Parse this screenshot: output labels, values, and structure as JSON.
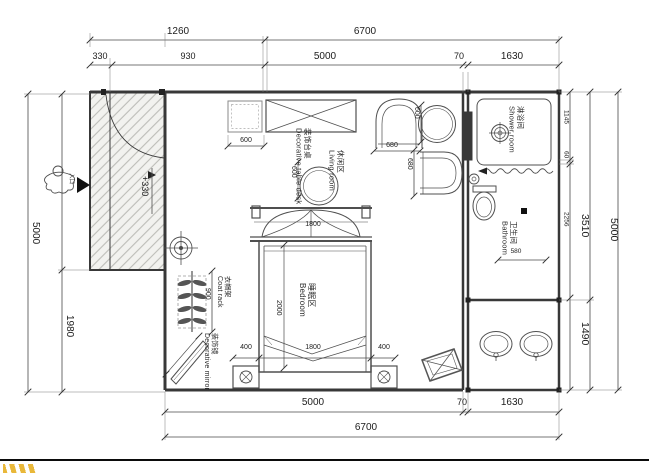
{
  "plan": {
    "dims": {
      "t1260": "1260",
      "t6700": "6700",
      "t330": "330",
      "t930": "930",
      "t5000": "5000",
      "t70": "70",
      "t1630": "1630",
      "b5000": "5000",
      "b70": "70",
      "b1630": "1630",
      "b6700": "6700",
      "l5000": "5000",
      "l1980": "1980",
      "r1145": "1145",
      "r60": "60",
      "r2256": "2256",
      "r3510": "3510",
      "r1490": "1490",
      "r5000": "5000",
      "cab600": "600",
      "tbl600": "600",
      "seat600": "600",
      "chair680w": "680",
      "chair680d": "680",
      "canopy1800": "1800",
      "bed2000": "2000",
      "bed1800": "1800",
      "nl400": "400",
      "nr400": "400",
      "coat900": "900",
      "bath580": "580",
      "level": "+330"
    },
    "labels": {
      "entrance": "入口",
      "decor_table": {
        "zh": "装饰台桌",
        "en": "Decorative table desk"
      },
      "living": {
        "zh": "休闲区",
        "en": "Living room"
      },
      "bedroom": {
        "zh": "睡眠区",
        "en": "Bedroom"
      },
      "shower": {
        "zh": "淋浴间",
        "en": "Shower room"
      },
      "bathroom": {
        "zh": "卫生间",
        "en": "Bathroom"
      },
      "coat_rack": {
        "zh": "衣帽架",
        "en": "Coat rack"
      },
      "mirror": {
        "zh": "装饰镜",
        "en": "Decorative mirror"
      }
    },
    "colors": {
      "line": "#383838",
      "hatch_bg": "#f2f2ef",
      "accent_mark": "#e9b83a"
    }
  }
}
